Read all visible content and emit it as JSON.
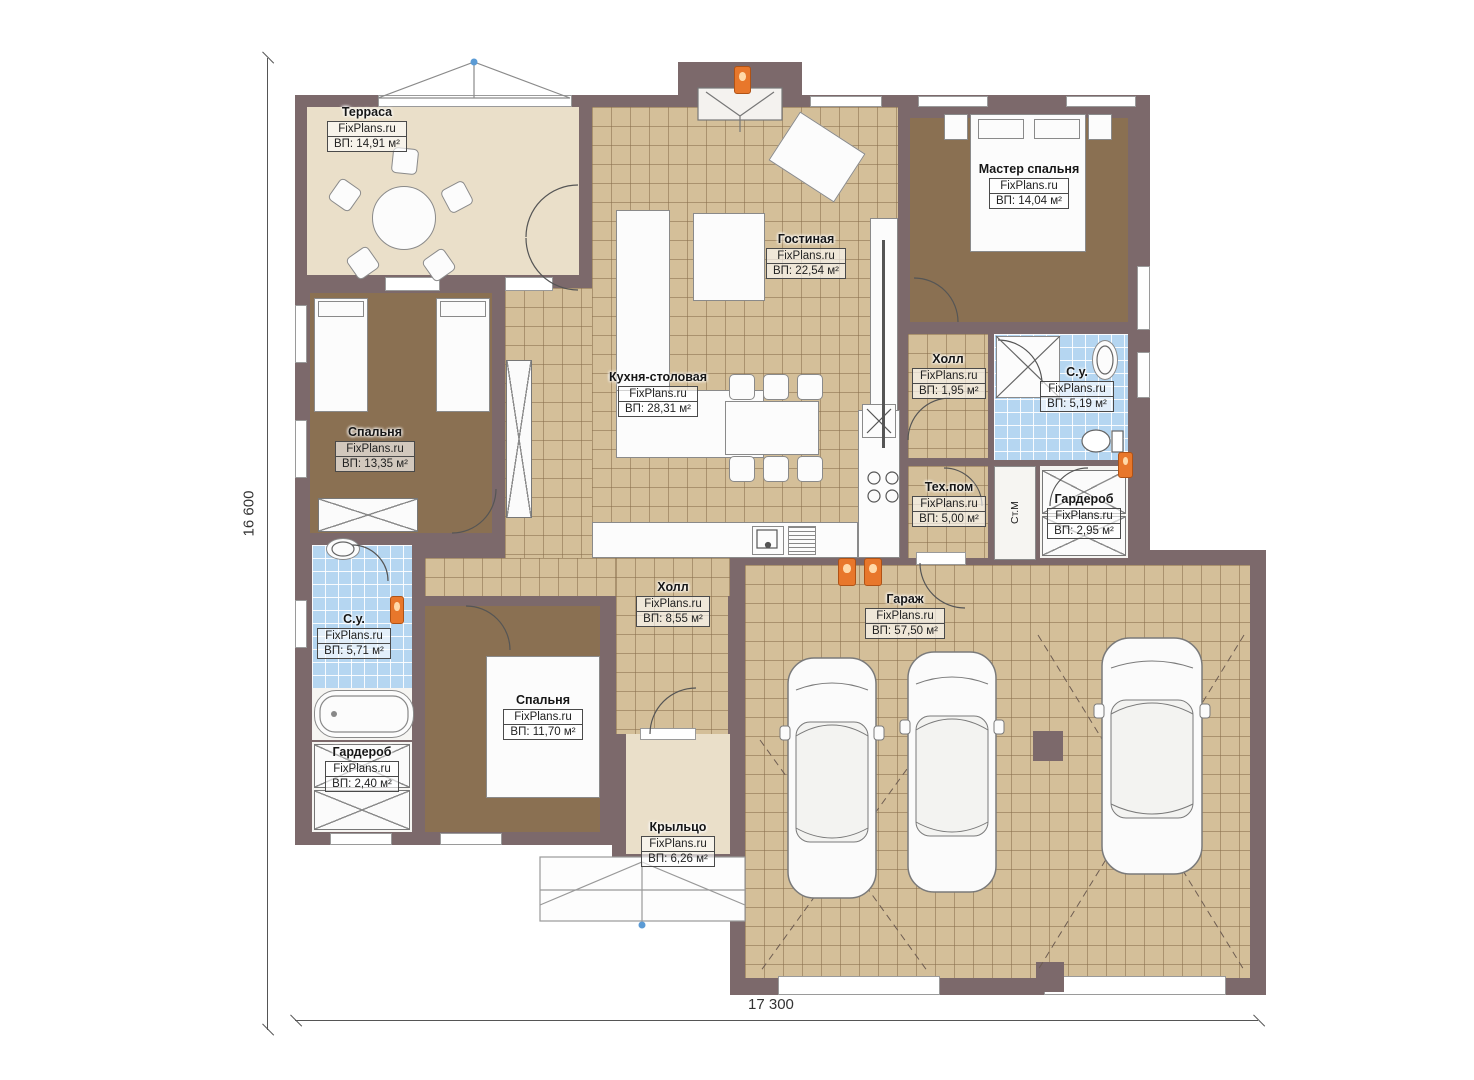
{
  "brand": "FixPlans.ru",
  "dimensions": {
    "height_label": "16 600",
    "width_label": "17 300"
  },
  "rooms": [
    {
      "name": "Терраса",
      "area": "ВП: 14,91 м²"
    },
    {
      "name": "Гостиная",
      "area": "ВП: 22,54 м²"
    },
    {
      "name": "Мастер спальня",
      "area": "ВП: 14,04 м²"
    },
    {
      "name": "Кухня-столовая",
      "area": "ВП: 28,31 м²"
    },
    {
      "name": "Холл",
      "area": "ВП: 1,95 м²"
    },
    {
      "name": "С.у.",
      "area": "ВП: 5,19 м²"
    },
    {
      "name": "Тех.пом",
      "area": "ВП: 5,00 м²"
    },
    {
      "name": "Гардероб",
      "area": "ВП: 2,95 м²"
    },
    {
      "name": "Спальня",
      "area": "ВП: 13,35 м²"
    },
    {
      "name": "Холл",
      "area": "ВП: 8,55 м²"
    },
    {
      "name": "С.у.",
      "area": "ВП: 5,71 м²"
    },
    {
      "name": "Гардероб",
      "area": "ВП: 2,40 м²"
    },
    {
      "name": "Спальня",
      "area": "ВП: 11,70 м²"
    },
    {
      "name": "Крыльцо",
      "area": "ВП: 6,26 м²"
    },
    {
      "name": "Гараж",
      "area": "ВП: 57,50 м²"
    }
  ],
  "fixtures": {
    "washing_machine": "Ст.М"
  },
  "colors": {
    "wall": "#7c696b",
    "tile": "#d4bf99",
    "carpet": "#8a7052",
    "blue_tile": "#b5d6f1",
    "terrace": "#eadfc9",
    "accent": "#e8772b"
  }
}
